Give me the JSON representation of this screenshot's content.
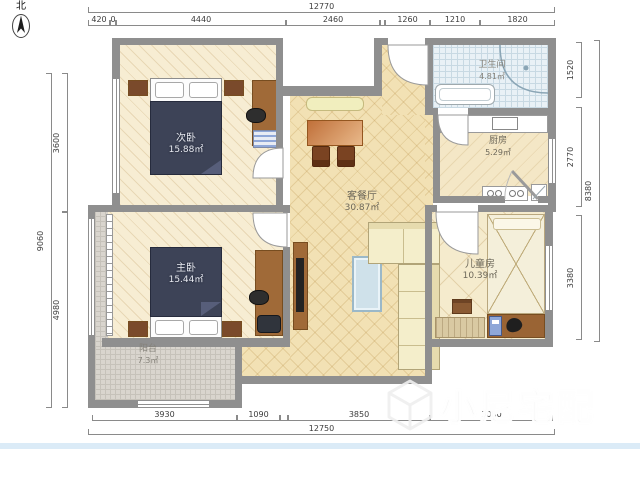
{
  "compass": {
    "label": "北"
  },
  "watermark": {
    "text": "小尼宅配"
  },
  "rooms": {
    "secondary_bedroom": {
      "name": "次卧",
      "area": "15.88㎡"
    },
    "master_bedroom": {
      "name": "主卧",
      "area": "15.44㎡"
    },
    "living_dining": {
      "name": "客餐厅",
      "area": "30.87㎡"
    },
    "bathroom": {
      "name": "卫生间",
      "area": "4.81㎡"
    },
    "kitchen": {
      "name": "厨房",
      "area": "5.29㎡"
    },
    "kids_room": {
      "name": "儿童房",
      "area": "10.39㎡"
    },
    "balcony": {
      "name": "阳台",
      "area": "7.3㎡"
    }
  },
  "dimensions": {
    "top_total": "12770",
    "top_segments": [
      "420",
      "0",
      "4440",
      "2460",
      "1260",
      "1210",
      "1820"
    ],
    "bottom_segments": [
      "3930",
      "1090",
      "3850",
      "3080"
    ],
    "bottom_total": "12750",
    "left_total": "9060",
    "left_segments": [
      "3600",
      "4980"
    ],
    "right_total": "8380",
    "right_segments": [
      "1520",
      "2770",
      "3380"
    ]
  },
  "colors": {
    "wall": "#8f8f8f",
    "bedroom_floor": "#f7edd3",
    "living_floor": "#f2e1b4",
    "balcony_tile": "#d9d5ce",
    "bathroom_tile": "#e9f1f6",
    "bed_blanket": "#3d4357",
    "wood_brown": "#a06a38"
  }
}
